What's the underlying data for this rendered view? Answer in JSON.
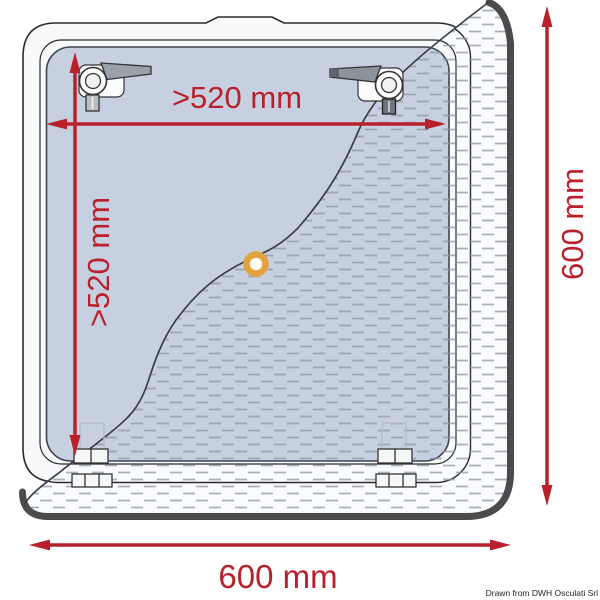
{
  "diagram": {
    "attribution": "Drawn from DWH Osculati Srl",
    "dims": {
      "inner_width": ">520 mm",
      "inner_height": ">520 mm",
      "outer_width": "600 mm",
      "outer_height": "600 mm"
    },
    "colors": {
      "dimension_red": "#b8202c",
      "glass_blue": "#c7d0e0",
      "frame_white": "#f8f9fa",
      "cutout_rim_dark": "#4b4b4b",
      "grommet_orange": "#e2a33e"
    },
    "icons": {
      "latches": "latch-handle-icon",
      "hinges": "hinge-icon",
      "grommet": "grommet-icon",
      "arrows": "dimension-arrow-icon"
    }
  }
}
